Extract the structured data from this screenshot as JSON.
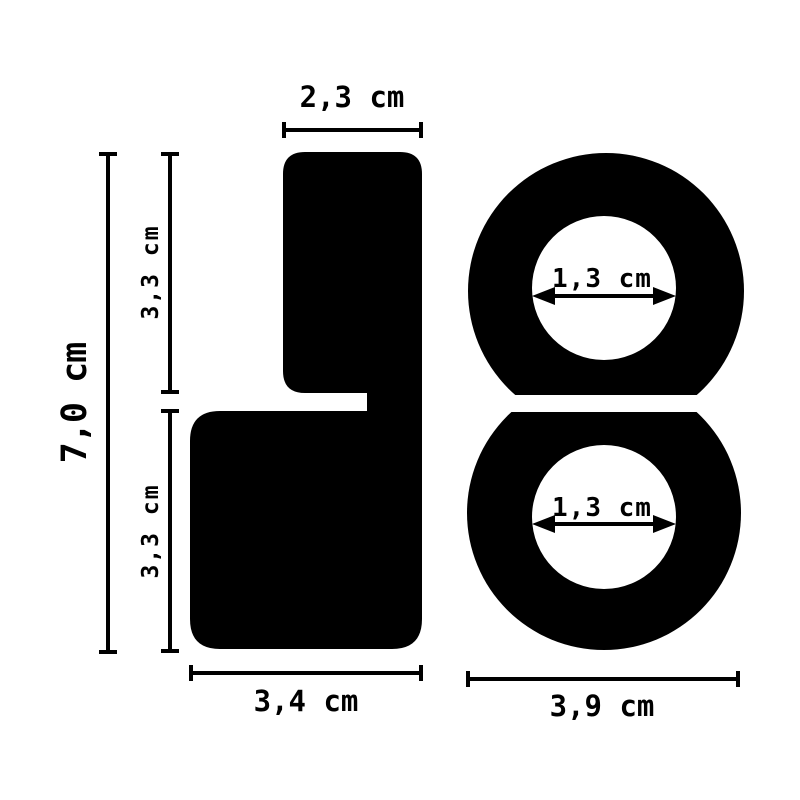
{
  "page": {
    "background_color": "#ffffff",
    "ink_color": "#000000"
  },
  "diagram": {
    "type": "product-dimension-diagram",
    "side_view": {
      "top_width_label": "2,3 cm",
      "total_height_label": "7,0 cm",
      "upper_height_label": "3,3 cm",
      "lower_height_label": "3,3 cm",
      "bottom_width_label": "3,4 cm"
    },
    "front_view": {
      "top_ring_inner_diameter_label": "1,3 cm",
      "bottom_ring_inner_diameter_label": "1,3 cm",
      "outer_width_label": "3,9 cm"
    }
  }
}
